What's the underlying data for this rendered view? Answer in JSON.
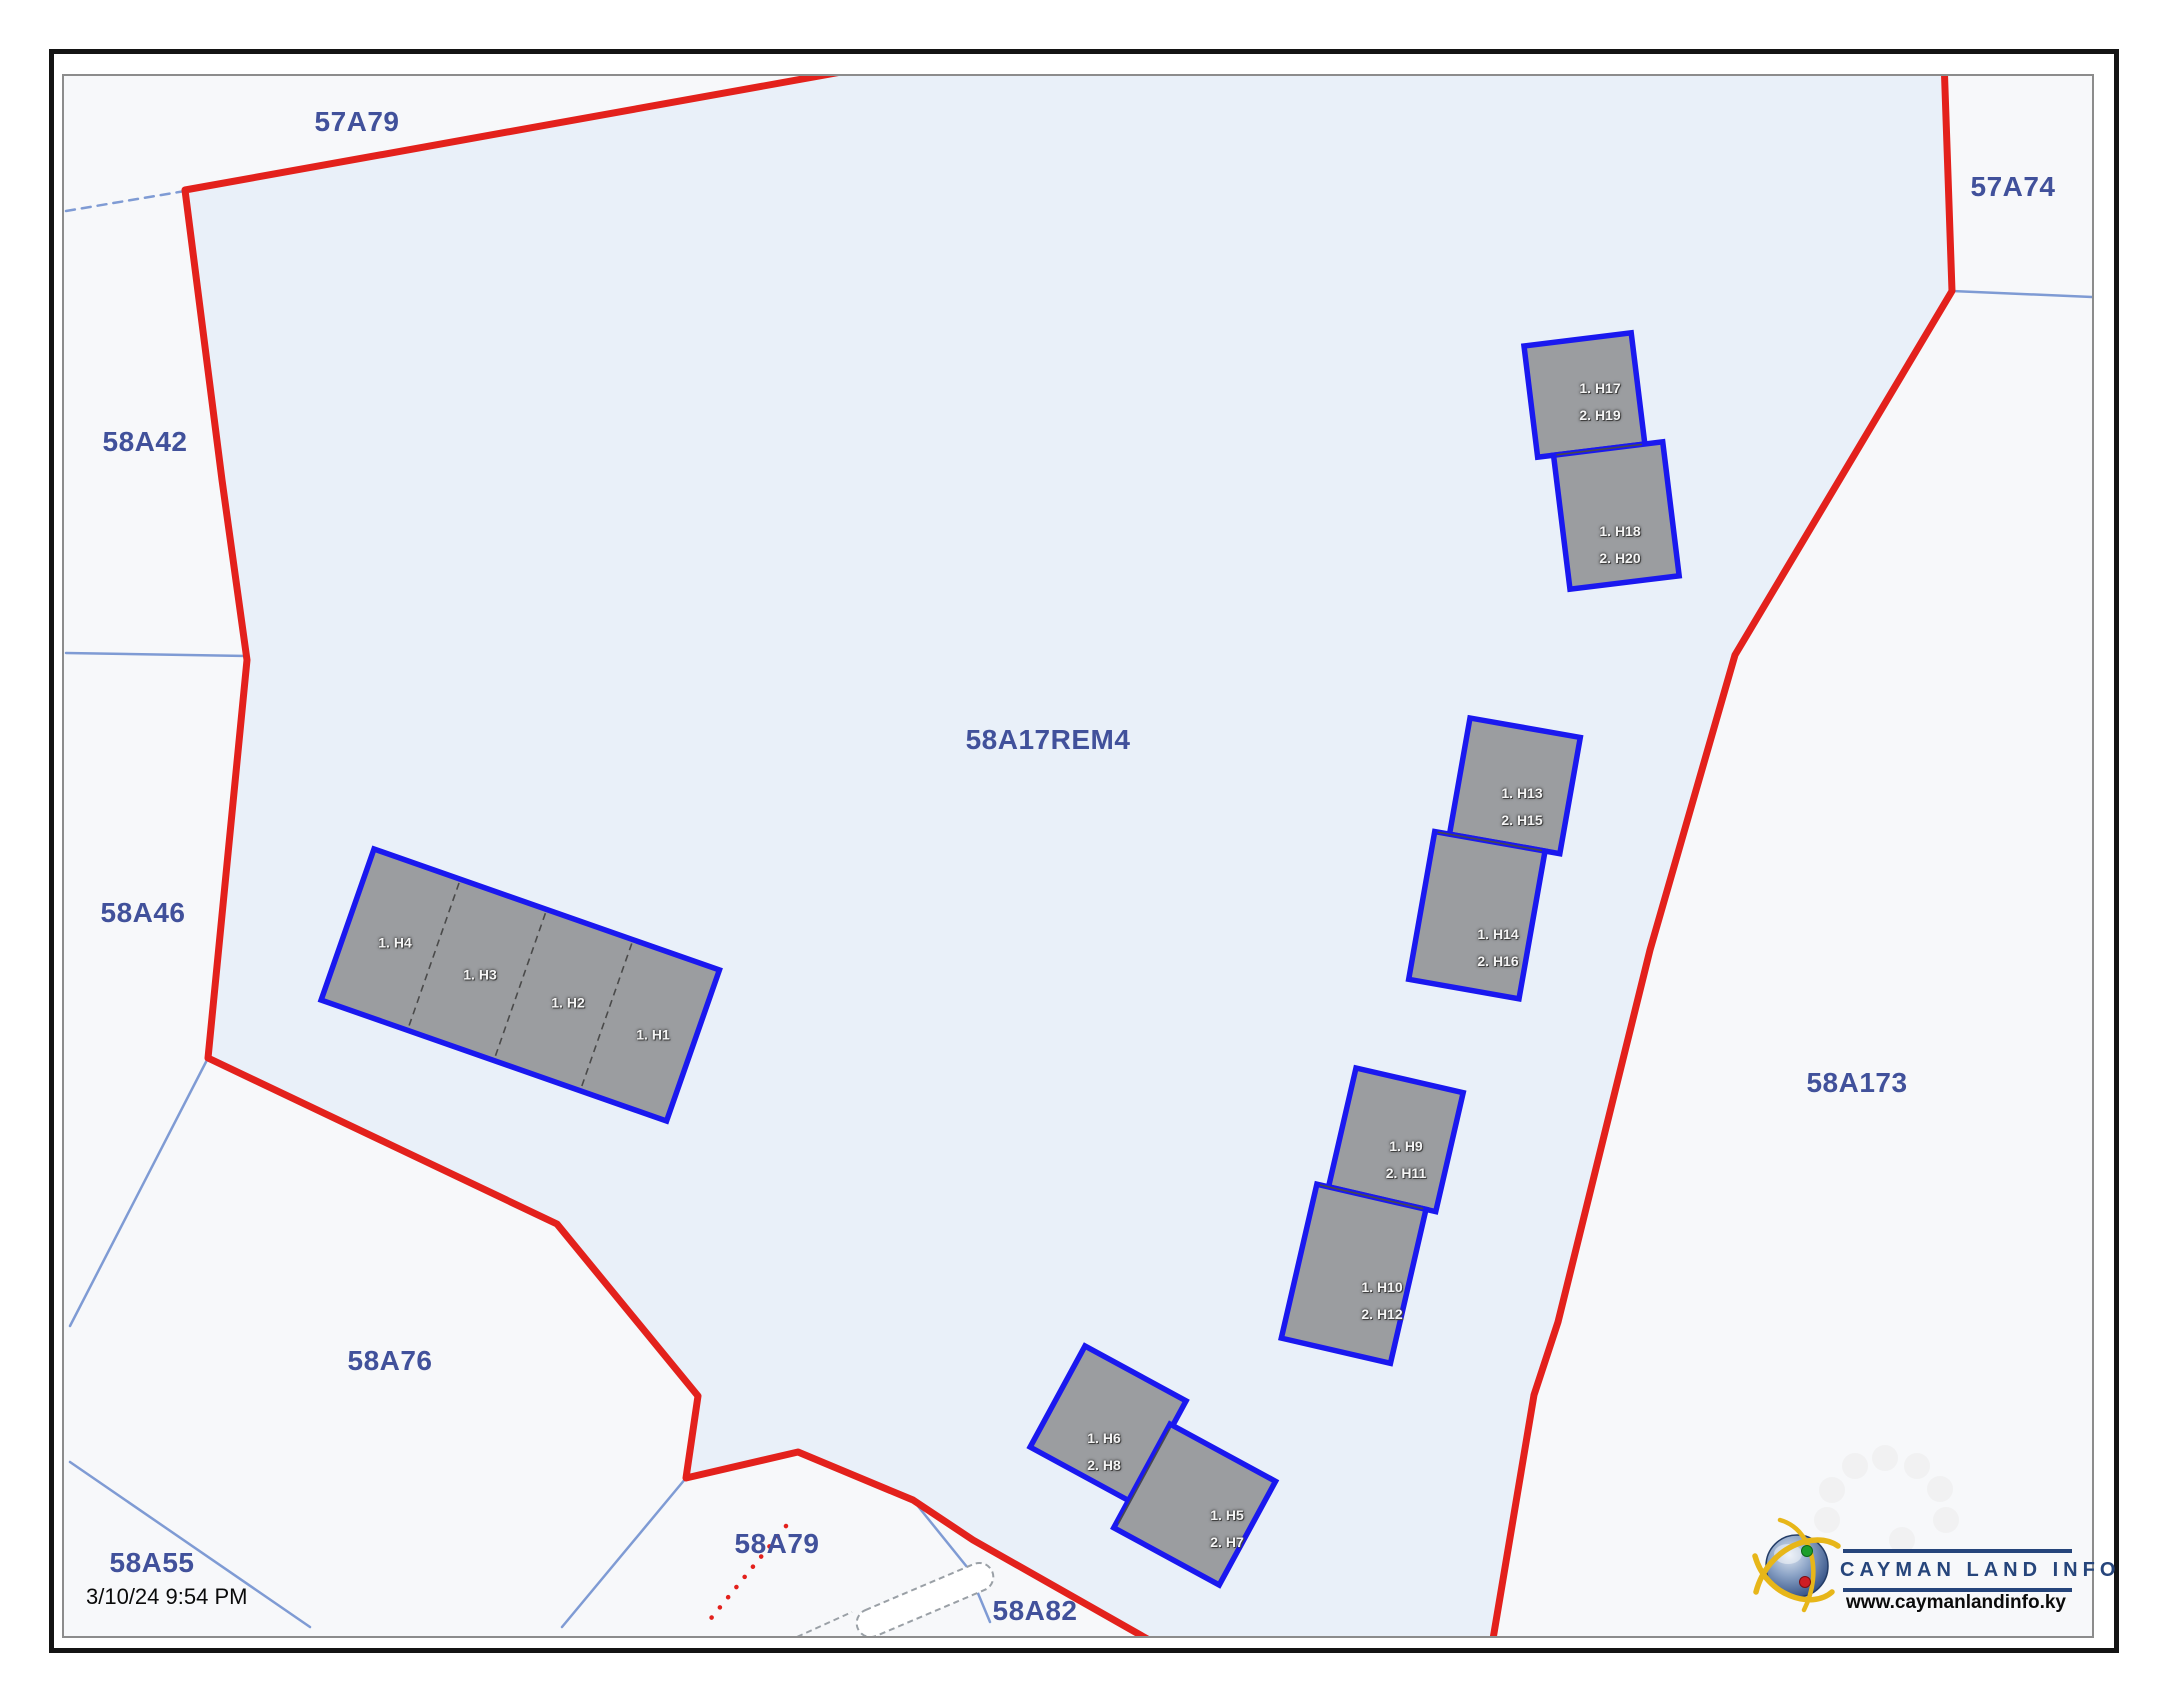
{
  "page": {
    "timestamp": "3/10/24 9:54 PM"
  },
  "parcel_labels": {
    "p57A79": "57A79",
    "p57A74": "57A74",
    "p58A42": "58A42",
    "p58A46": "58A46",
    "p58A17REM4": "58A17REM4",
    "p58A173": "58A173",
    "p58A76": "58A76",
    "p58A55": "58A55",
    "p58A79": "58A79",
    "p58A82": "58A82"
  },
  "building_units": {
    "strip": {
      "u4": "1. H4",
      "u3": "1. H3",
      "u2": "1. H2",
      "u1": "1. H1"
    },
    "duplex_ne": {
      "upper_1": "1. H17",
      "upper_2": "2. H19",
      "lower_1": "1. H18",
      "lower_2": "2. H20"
    },
    "duplex_mid": {
      "upper_1": "1. H13",
      "upper_2": "2. H15",
      "lower_1": "1. H14",
      "lower_2": "2. H16"
    },
    "duplex_s": {
      "upper_1": "1. H9",
      "upper_2": "2. H11",
      "lower_1": "1. H10",
      "lower_2": "2. H12"
    },
    "duplex_sw": {
      "left_1": "1. H6",
      "left_2": "2. H8",
      "right_1": "1. H5",
      "right_2": "2. H7"
    }
  },
  "logo": {
    "name": "CAYMAN LAND INFO",
    "website": "www.caymanlandinfo.ky"
  },
  "colors": {
    "boundary_red": "#e3211c",
    "building_outline_blue": "#1a18ef",
    "building_fill": "#9b9da0",
    "parcel_fill": "#e9f0f9",
    "parcel_line_blue": "#7f9bd4",
    "label_navy": "#41519b",
    "logo_navy": "#26457b"
  }
}
